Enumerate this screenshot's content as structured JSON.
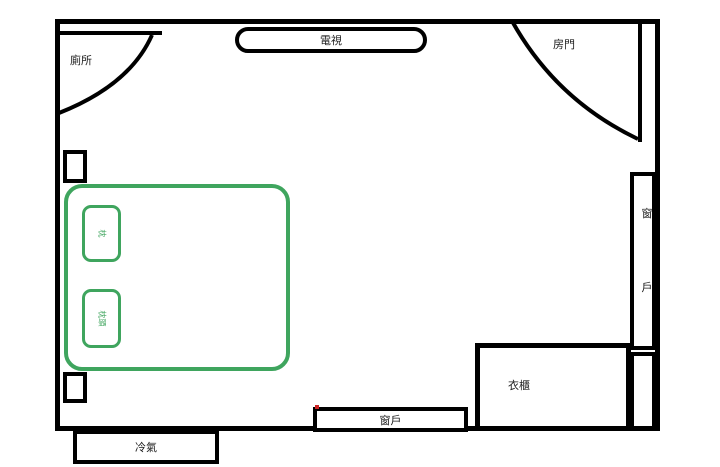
{
  "diagram_type": "bedroom floor plan",
  "colors": {
    "line": "#000000",
    "furniture_green": "#3fa55e",
    "mark_red": "#cc2222"
  },
  "rooms": {
    "toilet_label": "廁所",
    "door_label": "房門"
  },
  "furniture": {
    "tv_label": "電視",
    "wardrobe_label": "衣櫃",
    "aircon_label": "冷氣",
    "window_bottom_label": "窗戶",
    "window_right_chars": [
      "窗",
      "戶"
    ],
    "bed": {
      "pillow1_label": "枕",
      "pillow2_label": "枕頭"
    }
  }
}
